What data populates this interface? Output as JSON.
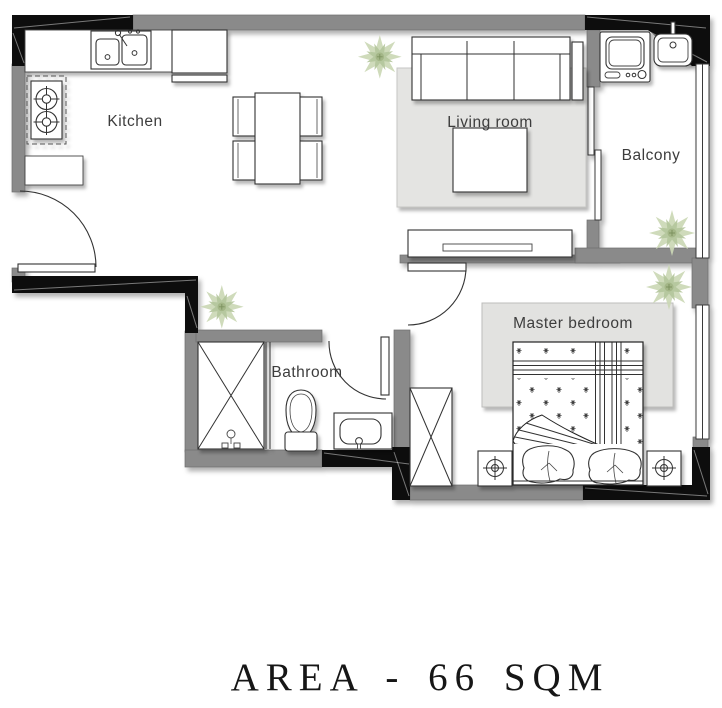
{
  "title": "AREA - 66 SQM",
  "rooms": {
    "kitchen": "Kitchen",
    "living_room": "Living room",
    "balcony": "Balcony",
    "bathroom": "Bathroom",
    "master_bedroom": "Master bedroom"
  },
  "fixtures": [
    "entry-door",
    "kitchen-sink",
    "stove",
    "fridge-cabinet",
    "kitchen-counter",
    "dining-table",
    "dining-chairs",
    "sofa",
    "coffee-table",
    "tv-console",
    "sliding-door",
    "washing-machine",
    "balcony-sink",
    "balcony-window",
    "shower",
    "toilet",
    "bathroom-sink",
    "bathroom-door",
    "bedroom-door",
    "wardrobe",
    "double-bed",
    "pillows",
    "nightstands",
    "bedroom-window",
    "plants",
    "rugs"
  ],
  "colors": {
    "wall_gray": "#8a8a8a",
    "wall_black": "#0c0c0c",
    "rug": "#e4e4e2",
    "plant_light": "#ccd8b6",
    "plant_dark": "#b4c69c",
    "label_text": "#3d3d3d",
    "title_text": "#161616"
  }
}
